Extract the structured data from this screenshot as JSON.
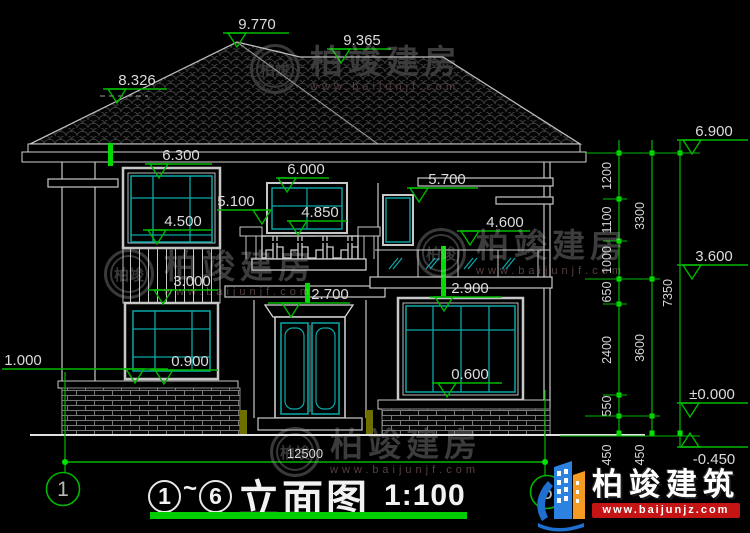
{
  "title_block": {
    "grid_start": "1",
    "tilde": "~",
    "grid_end": "6",
    "title": "立面图",
    "scale": "1:100"
  },
  "logo": {
    "brand": "柏竣建筑",
    "url": "www.baijunjz.com"
  },
  "watermark": {
    "brand": "柏竣建房",
    "url": "www.baijunjf.com",
    "seal": "柏竣",
    "positions": [
      {
        "x": 250,
        "y": 44
      },
      {
        "x": 104,
        "y": 249
      },
      {
        "x": 416,
        "y": 228
      },
      {
        "x": 270,
        "y": 427
      }
    ]
  },
  "colors": {
    "dim_green": "#00b800",
    "bright_green": "#00e400",
    "teal": "#0aa8a8",
    "line": "#d9d9d9",
    "underline_green": "#00ce00",
    "logo_blue": "#1e6fd0",
    "logo_orange": "#f59a23",
    "logo_red": "#c41414"
  },
  "elevation_markers": [
    {
      "label": "9.770",
      "lx": 223,
      "ly": 33,
      "len": 66,
      "tip": 237,
      "tx": 257
    },
    {
      "label": "9.365",
      "lx": 327,
      "ly": 49,
      "len": 64,
      "tip": 341,
      "tx": 362
    },
    {
      "label": "8.326",
      "lx": 103,
      "ly": 89,
      "len": 64,
      "tip": 117,
      "tx": 137
    },
    {
      "label": "6.300",
      "lx": 145,
      "ly": 164,
      "len": 67,
      "tip": 159,
      "tx": 181
    },
    {
      "label": "6.000",
      "lx": 276,
      "ly": 178,
      "len": 53,
      "tip": 287,
      "tx": 306
    },
    {
      "label": "5.700",
      "lx": 407,
      "ly": 188,
      "len": 71,
      "tip": 419,
      "tx": 447
    },
    {
      "label": "5.100",
      "lx": 217,
      "ly": 210,
      "len": 42,
      "tip": 262,
      "tx": 236
    },
    {
      "label": "4.850",
      "lx": 287,
      "ly": 221,
      "len": 60,
      "tip": 298,
      "tx": 320
    },
    {
      "label": "4.600",
      "lx": 457,
      "ly": 231,
      "len": 73,
      "tip": 470,
      "tx": 505
    },
    {
      "label": "4.500",
      "lx": 143,
      "ly": 230,
      "len": 69,
      "tip": 157,
      "tx": 183
    },
    {
      "label": "3.000",
      "lx": 148,
      "ly": 290,
      "len": 70,
      "tip": 163,
      "tx": 192
    },
    {
      "label": "2.700",
      "lx": 268,
      "ly": 303,
      "len": 82,
      "tip": 291,
      "tx": 330
    },
    {
      "label": "2.900",
      "lx": 430,
      "ly": 297,
      "len": 72,
      "tip": 444,
      "tx": 470
    },
    {
      "label": "0.900",
      "lx": 150,
      "ly": 370,
      "len": 68,
      "tip": 164,
      "tx": 190
    },
    {
      "label": "0.600",
      "lx": 432,
      "ly": 383,
      "len": 70,
      "tip": 447,
      "tx": 470
    },
    {
      "label": "1.000",
      "lx": 2,
      "ly": 369,
      "len": 166,
      "tip": 135,
      "tx": 23
    },
    {
      "label": "6.900",
      "lx": 677,
      "ly": 140,
      "len": 71,
      "tip": 692,
      "tx": 714
    },
    {
      "label": "3.600",
      "lx": 677,
      "ly": 265,
      "len": 71,
      "tip": 692,
      "tx": 714
    },
    {
      "label": "±0.000",
      "lx": 677,
      "ly": 403,
      "len": 71,
      "tip": 690,
      "tx": 712
    },
    {
      "label": "-0.450",
      "lx": 677,
      "ly": 447,
      "len": 71,
      "tip": 690,
      "tx": 714,
      "up": true
    }
  ],
  "dim_chains": {
    "columns": [
      {
        "x": 619,
        "top": 140,
        "bottom": 436,
        "ticks": [
          153,
          199,
          241,
          279,
          304,
          395,
          416,
          433
        ],
        "labels": [
          {
            "text": "1200",
            "y": 176
          },
          {
            "text": "1100",
            "y": 220
          },
          {
            "text": "1000",
            "y": 260
          },
          {
            "text": "650",
            "y": 292
          },
          {
            "text": "2400",
            "y": 350
          },
          {
            "text": "550",
            "y": 406
          },
          {
            "text": "450",
            "y": 455
          }
        ]
      },
      {
        "x": 652,
        "top": 140,
        "bottom": 436,
        "ticks": [
          153,
          279,
          416,
          433
        ],
        "labels": [
          {
            "text": "3300",
            "y": 216
          },
          {
            "text": "3600",
            "y": 348
          },
          {
            "text": "450",
            "y": 455
          }
        ]
      },
      {
        "x": 680,
        "top": 140,
        "bottom": 447,
        "ticks": [
          153,
          433
        ],
        "labels": [
          {
            "text": "7350",
            "y": 293
          }
        ]
      }
    ],
    "connectors": [
      {
        "y": 153,
        "x1": 585,
        "x2": 700
      },
      {
        "y": 199,
        "x1": 603,
        "x2": 627
      },
      {
        "y": 241,
        "x1": 603,
        "x2": 627
      },
      {
        "y": 279,
        "x1": 585,
        "x2": 660
      },
      {
        "y": 304,
        "x1": 603,
        "x2": 627
      },
      {
        "y": 395,
        "x1": 603,
        "x2": 627
      },
      {
        "y": 416,
        "x1": 585,
        "x2": 660
      },
      {
        "y": 436,
        "x1": 560,
        "x2": 700
      }
    ]
  },
  "bottom_dim": {
    "label": "12500",
    "y": 462,
    "x1": 65,
    "x2": 545,
    "label_x": 305,
    "label_y": 458
  },
  "grid_bubbles": [
    {
      "label": "1",
      "cx": 63,
      "cy": 489
    },
    {
      "label": "6",
      "cx": 547,
      "cy": 492
    }
  ]
}
